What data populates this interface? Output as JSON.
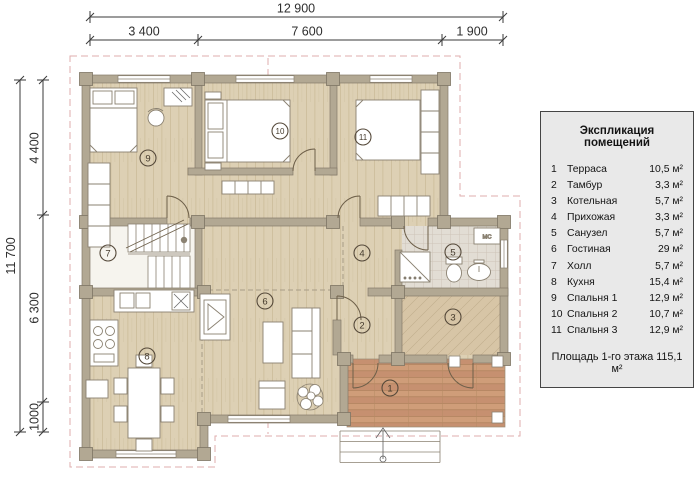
{
  "dimensions": {
    "top_total": "12 900",
    "top_seg1": "3 400",
    "top_seg2": "7 600",
    "top_seg3": "1 900",
    "left_total": "11 700",
    "left_seg1": "4 400",
    "left_seg2": "6 300",
    "left_seg3": "1000"
  },
  "legend": {
    "title": "Экспликация помещений",
    "items": [
      {
        "num": "1",
        "name": "Терраса",
        "area": "10,5 м²"
      },
      {
        "num": "2",
        "name": "Тамбур",
        "area": "3,3 м²"
      },
      {
        "num": "3",
        "name": "Котельная",
        "area": "5,7 м²"
      },
      {
        "num": "4",
        "name": "Прихожая",
        "area": "3,3 м²"
      },
      {
        "num": "5",
        "name": "Санузел",
        "area": "5,7 м²"
      },
      {
        "num": "6",
        "name": "Гостиная",
        "area": "29 м²"
      },
      {
        "num": "7",
        "name": "Холл",
        "area": "5,7 м²"
      },
      {
        "num": "8",
        "name": "Кухня",
        "area": "15,4 м²"
      },
      {
        "num": "9",
        "name": "Спальня 1",
        "area": "12,9 м²"
      },
      {
        "num": "10",
        "name": "Спальня 2",
        "area": "10,7 м²"
      },
      {
        "num": "11",
        "name": "Спальня 3",
        "area": "12,9 м²"
      }
    ],
    "footer": "Площадь 1-го этажа 115,1 м²"
  },
  "plan": {
    "rooms": {
      "r1": "1",
      "r2": "2",
      "r3": "3",
      "r4": "4",
      "r5": "5",
      "r6": "6",
      "r7": "7",
      "r8": "8",
      "r9": "9",
      "r10": "10",
      "r11": "11"
    },
    "mc_label": "МС"
  },
  "colors": {
    "wall": "#b2a893",
    "floor": "#ddd0b4",
    "terrace": "#cf9d79",
    "roof_dash": "#dfaeae",
    "panel_bg": "#e9e9e9"
  }
}
